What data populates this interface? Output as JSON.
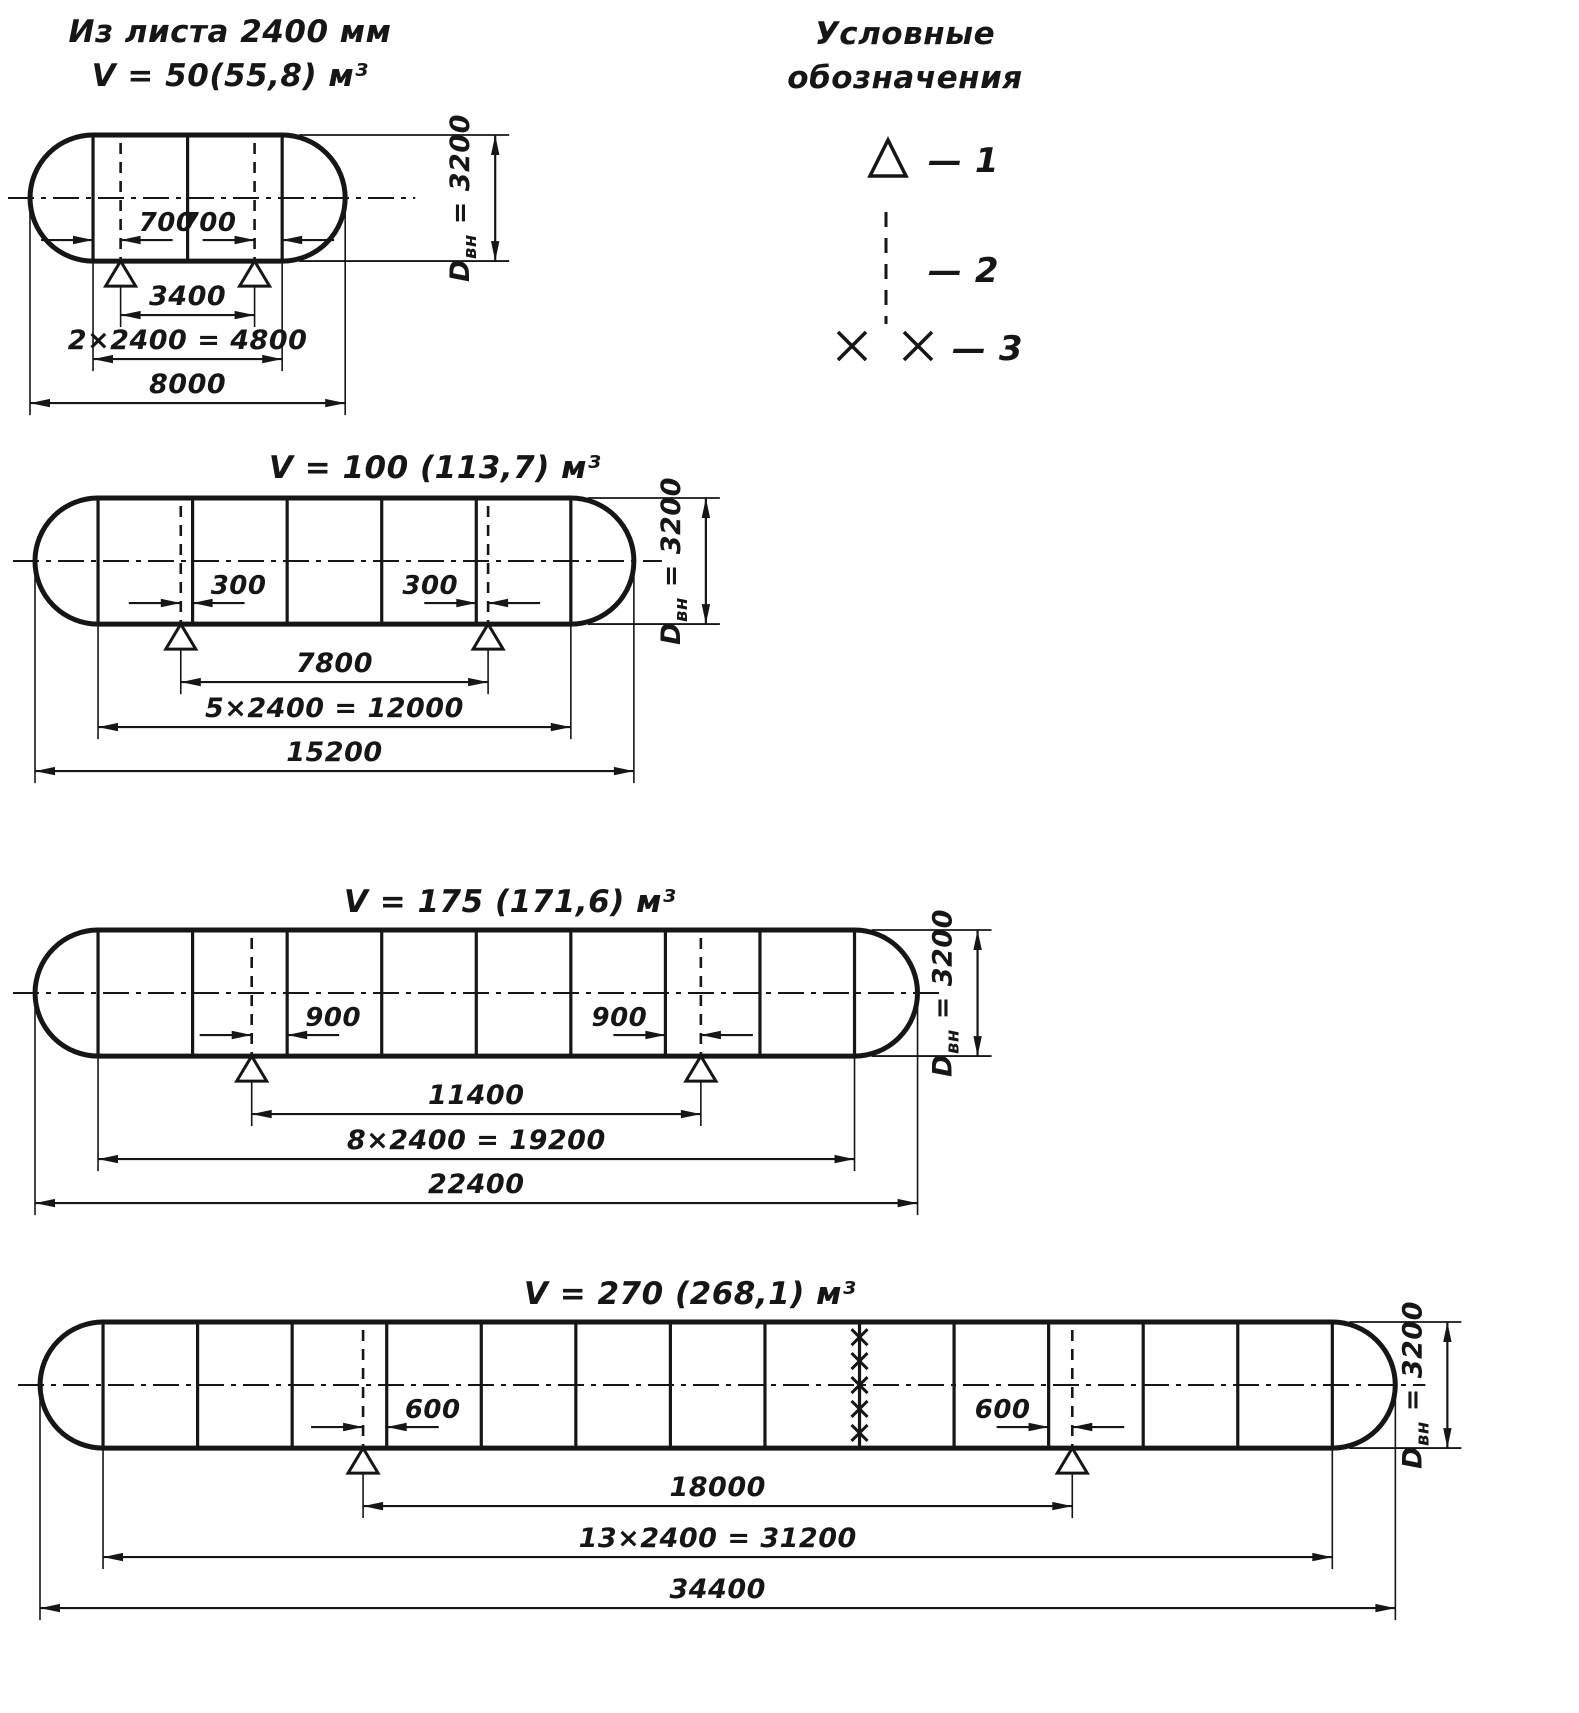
{
  "style": {
    "ink": "#161616",
    "background": "#ffffff"
  },
  "legend": {
    "title_lines": [
      "Условные",
      "обозначения"
    ],
    "items": [
      {
        "symbol": "support-triangle-icon",
        "label": "— 1"
      },
      {
        "symbol": "dashed-centerline-icon",
        "label": "— 2"
      },
      {
        "symbol": "cross-pair-icon",
        "label": "— 3"
      }
    ]
  },
  "tanks": [
    {
      "title_lines": [
        "Из листа 2400 мм",
        "V = 50(55,8) м³"
      ],
      "geometry": {
        "length_mm": 8000,
        "shell_mm": 4800,
        "courses": 2,
        "course_mm": 2400,
        "head_mm": 1600,
        "diameter_mm": 3200,
        "support_span_mm": 3400,
        "support_offset_mm": 700,
        "offset_pairs_mm": [
          [
            1600,
            2300
          ],
          [
            5700,
            6400
          ]
        ]
      },
      "labels": {
        "offset_left": "700",
        "offset_right": "700",
        "span": "3400",
        "shell": "2×2400 = 4800",
        "total": "8000",
        "diameter_parts": [
          "D",
          "вн",
          " = 3200"
        ]
      }
    },
    {
      "title_lines": [
        "V = 100 (113,7) м³"
      ],
      "geometry": {
        "length_mm": 15200,
        "shell_mm": 12000,
        "courses": 5,
        "course_mm": 2400,
        "head_mm": 1600,
        "diameter_mm": 3200,
        "support_span_mm": 7800,
        "support_offset_mm": 300,
        "offset_pairs_mm": [
          [
            3700,
            4000
          ],
          [
            11200,
            11500
          ]
        ]
      },
      "labels": {
        "offset_left": "300",
        "offset_right": "300",
        "span": "7800",
        "shell": "5×2400 = 12000",
        "total": "15200",
        "diameter_parts": [
          "D",
          "вн",
          " = 3200"
        ]
      }
    },
    {
      "title_lines": [
        "V = 175 (171,6) м³"
      ],
      "geometry": {
        "length_mm": 22400,
        "shell_mm": 19200,
        "courses": 8,
        "course_mm": 2400,
        "head_mm": 1600,
        "diameter_mm": 3200,
        "support_span_mm": 11400,
        "support_offset_mm": 900,
        "offset_pairs_mm": [
          [
            5500,
            6400
          ],
          [
            16000,
            16900
          ]
        ]
      },
      "labels": {
        "offset_left": "900",
        "offset_right": "900",
        "span": "11400",
        "shell": "8×2400 = 19200",
        "total": "22400",
        "diameter_parts": [
          "D",
          "вн",
          " = 3200"
        ]
      }
    },
    {
      "title_lines": [
        "V = 270 (268,1) м³"
      ],
      "geometry": {
        "length_mm": 34400,
        "shell_mm": 31200,
        "courses": 13,
        "course_mm": 2400,
        "head_mm": 1600,
        "diameter_mm": 3200,
        "support_span_mm": 18000,
        "support_offset_mm": 600,
        "offset_pairs_mm": [
          [
            8200,
            8800
          ],
          [
            25600,
            26200
          ]
        ]
      },
      "field_joint": {
        "seam_mm": 20800,
        "marks": 5
      },
      "labels": {
        "offset_left": "600",
        "offset_right": "600",
        "span": "18000",
        "shell": "13×2400 = 31200",
        "total": "34400",
        "diameter_parts": [
          "D",
          "вн",
          " = 3200"
        ]
      }
    }
  ]
}
